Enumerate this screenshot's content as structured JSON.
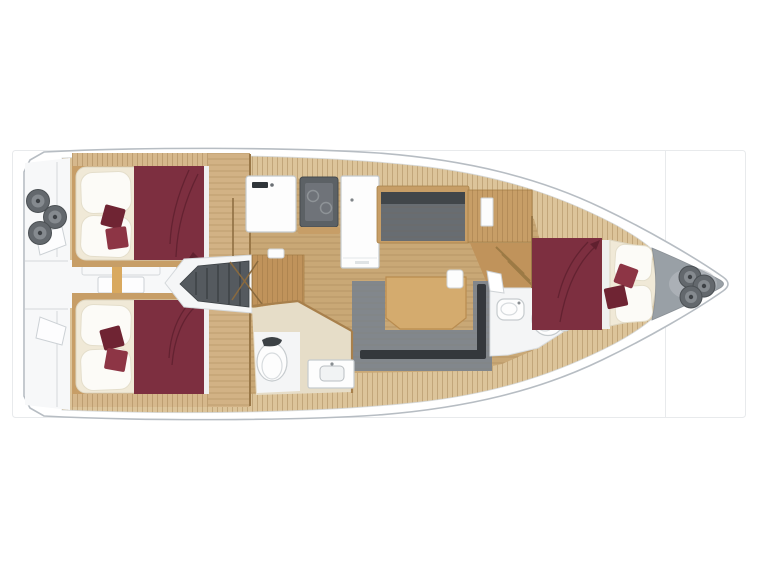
{
  "window": {
    "background": "#ffffff"
  },
  "listing_frame": {
    "border_color": "#e8eaec",
    "column_divider": "vertical-line"
  },
  "plan": {
    "kind": "sailing-yacht-interior-deck-plan",
    "orientation": "bow-right",
    "hull": {
      "fill": "#ffffff",
      "stroke": "#b7bdc3"
    },
    "colors": {
      "deck_wood": "#dcc49a",
      "sole_wood": "#c9a876",
      "cabin_wood": "#c79e67",
      "walk_wood": "#d2b285",
      "strip_wood": "#d6b88c",
      "cabinet_wood": "#c0935b",
      "table_wood": "#d4ab6e",
      "sill_wood": "#d9a95f",
      "mattress": "#f0e9d7",
      "pillow": "#fcfbf7",
      "blanket": "#7d2f40",
      "cushion_dark": "#6f2433",
      "cushion_bright": "#8d3545",
      "sofa": "#82878c",
      "sofa_back": "#34383c",
      "stove": "#5c6165",
      "settee": "#686d72",
      "settee_back": "#41464a",
      "stairs": "#555a5f",
      "winch": "#63686d",
      "bow_locker": "#99a0a6",
      "cockpit": "#f7f8f9",
      "bath_floor": "#f4f5f6",
      "bath_wood_floor": "#e6ddc8",
      "fixture_white": "#fdfdfd",
      "berth_edge_white": "#eff0f0"
    },
    "features": [
      {
        "id": "cockpit",
        "name": "stern cockpit with winches"
      },
      {
        "id": "aft-cabin-top",
        "name": "aft double cabin port"
      },
      {
        "id": "aft-cabin-bottom",
        "name": "aft double cabin starboard"
      },
      {
        "id": "companionway",
        "name": "companionway stairs"
      },
      {
        "id": "galley",
        "name": "galley with sink, stove, fridge"
      },
      {
        "id": "settee",
        "name": "straight settee"
      },
      {
        "id": "salon",
        "name": "salon U-sofa with table"
      },
      {
        "id": "aft-head",
        "name": "aft bathroom with toilet and sink"
      },
      {
        "id": "fwd-head",
        "name": "forward bathroom with toilet and sink"
      },
      {
        "id": "fwd-cabin",
        "name": "forward V-berth cabin"
      },
      {
        "id": "bow-locker",
        "name": "anchor locker with windlass"
      }
    ]
  }
}
